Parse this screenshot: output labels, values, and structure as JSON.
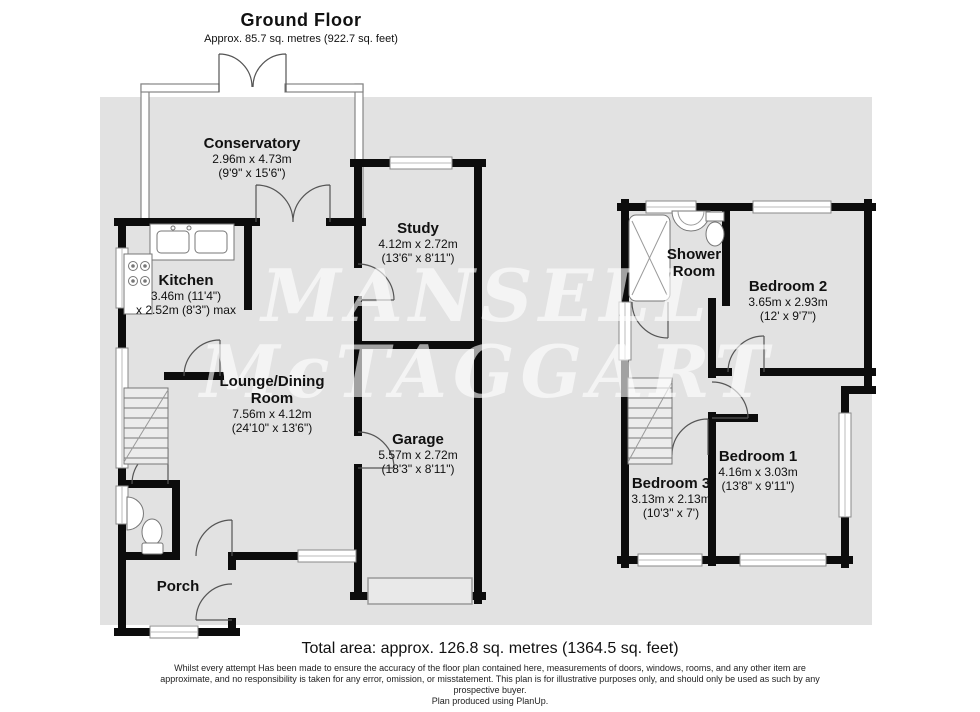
{
  "ground_floor": {
    "title": "Ground Floor",
    "subtitle": "Approx. 85.7 sq. metres (922.7 sq. feet)"
  },
  "first_floor": {
    "title": "First Floor",
    "subtitle": "Approx. 41.0 sq. metres (441.8 sq. feet)"
  },
  "rooms": {
    "conservatory": {
      "name": "Conservatory",
      "dim_metric": "2.96m x 4.73m",
      "dim_imperial": "(9'9\" x 15'6\")"
    },
    "kitchen": {
      "name": "Kitchen",
      "dim_metric": "3.46m (11'4\")",
      "dim_imperial": "x 2.52m (8'3\") max"
    },
    "study": {
      "name": "Study",
      "dim_metric": "4.12m x 2.72m",
      "dim_imperial": "(13'6\" x 8'11\")"
    },
    "lounge": {
      "name": "Lounge/Dining",
      "name2": "Room",
      "dim_metric": "7.56m x 4.12m",
      "dim_imperial": "(24'10\" x 13'6\")"
    },
    "garage": {
      "name": "Garage",
      "dim_metric": "5.57m x 2.72m",
      "dim_imperial": "(18'3\" x 8'11\")"
    },
    "porch": {
      "name": "Porch"
    },
    "shower_room": {
      "name": "Shower",
      "name2": "Room"
    },
    "bedroom2": {
      "name": "Bedroom 2",
      "dim_metric": "3.65m x 2.93m",
      "dim_imperial": "(12' x 9'7\")"
    },
    "bedroom3": {
      "name": "Bedroom 3",
      "dim_metric": "3.13m x 2.13m",
      "dim_imperial": "(10'3\" x 7')"
    },
    "bedroom1": {
      "name": "Bedroom 1",
      "dim_metric": "4.16m x 3.03m",
      "dim_imperial": "(13'8\" x 9'11\")"
    }
  },
  "watermark": {
    "line1": "MANSELL",
    "line2": "McTAGGART"
  },
  "footer": {
    "total_area": "Total area: approx. 126.8 sq. metres (1364.5 sq. feet)",
    "disclaimer_line1": "Whilst every attempt Has been made to ensure the accuracy of the floor plan contained here, measurements of doors, windows, rooms, and any other item are",
    "disclaimer_line2": "approximate, and no responsibility is taken for any error, omission, or misstatement. This plan is for illustrative purposes only, and should only be used as such by any",
    "disclaimer_line3": "prospective buyer.",
    "credit": "Plan produced using PlanUp."
  },
  "colors": {
    "wall": "#0c0c0c",
    "floor_background": "#e2e2e2",
    "fixture_stroke": "#777777",
    "door_arc": "#555555",
    "watermark": "rgba(255,255,255,0.62)"
  }
}
